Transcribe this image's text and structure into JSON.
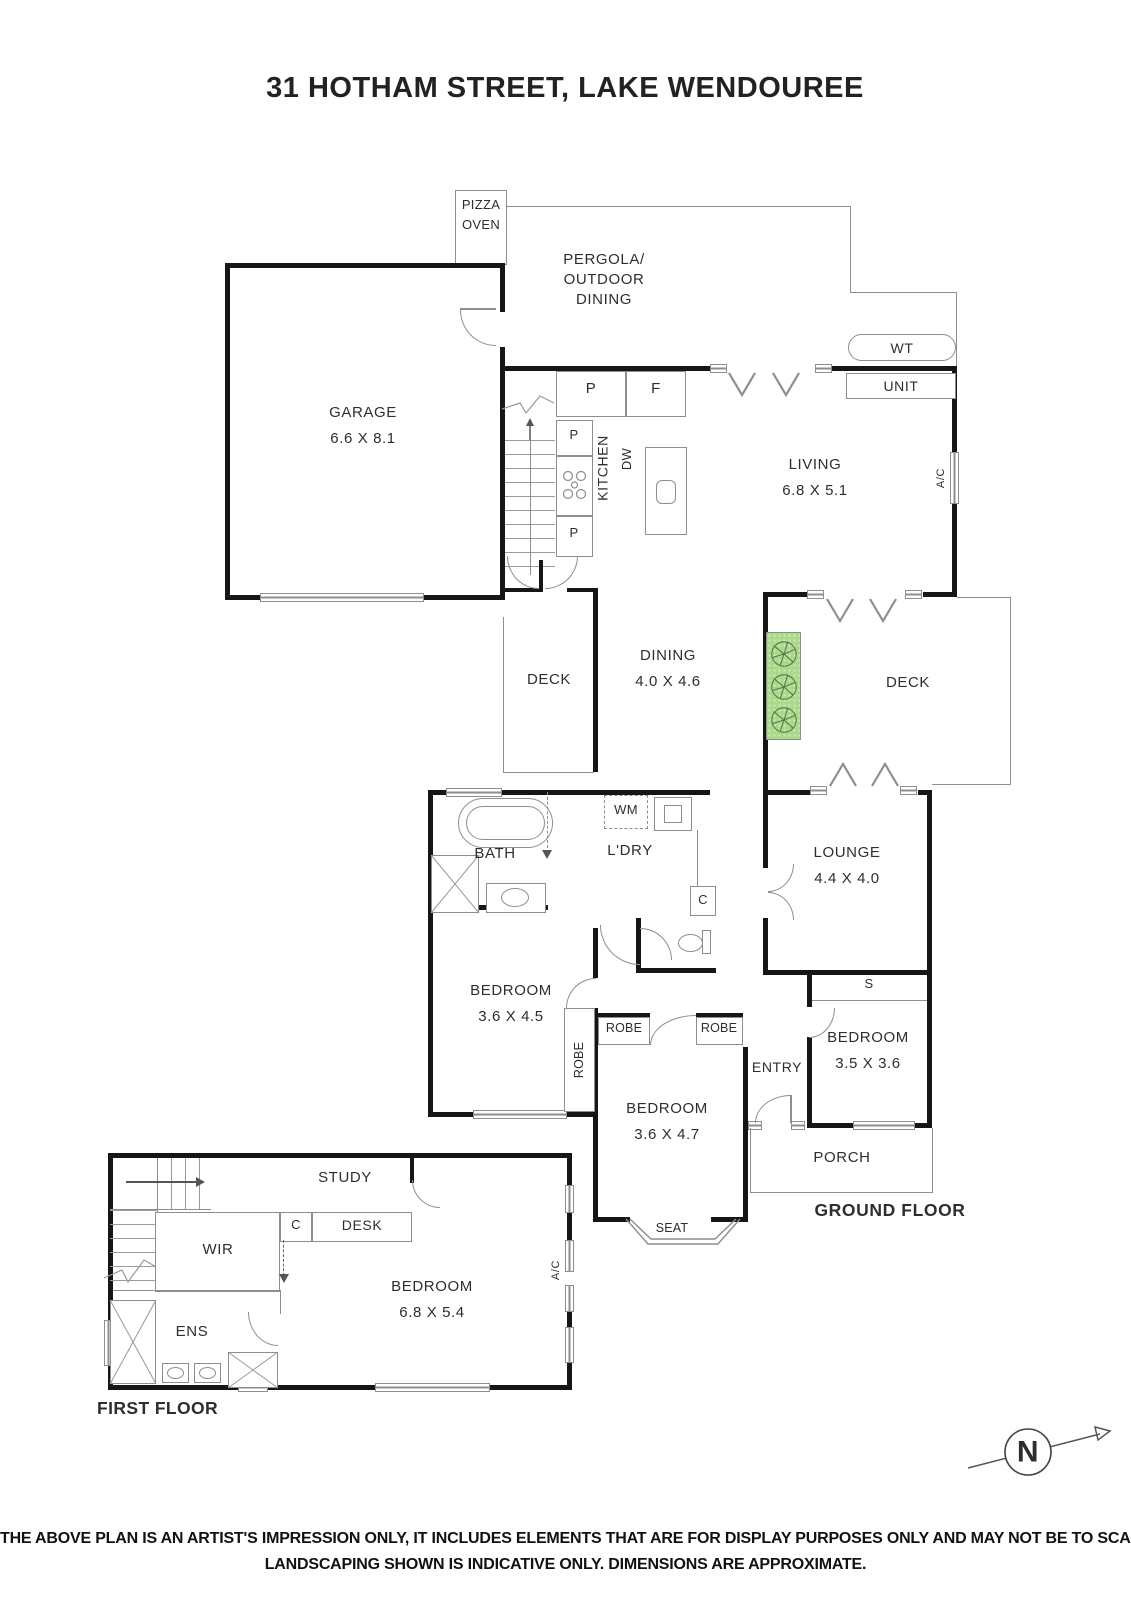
{
  "title": "31 HOTHAM STREET, LAKE WENDOUREE",
  "ground_floor": {
    "label": "GROUND FLOOR",
    "pizza_oven": {
      "line1": "PIZZA",
      "line2": "OVEN"
    },
    "pergola": {
      "line1": "PERGOLA/",
      "line2": "OUTDOOR",
      "line3": "DINING"
    },
    "garage": {
      "name": "GARAGE",
      "dims": "6.6 X 8.1"
    },
    "kitchen": {
      "name": "KITCHEN"
    },
    "living": {
      "name": "LIVING",
      "dims": "6.8 X 5.1"
    },
    "dining": {
      "name": "DINING",
      "dims": "4.0 X 4.6"
    },
    "deck": "DECK",
    "lounge": {
      "name": "LOUNGE",
      "dims": "4.4 X 4.0"
    },
    "bath": {
      "name": "BATH"
    },
    "laundry": {
      "name": "L'DRY"
    },
    "bedroom_rear": {
      "name": "BEDROOM",
      "dims": "3.6 X 4.5"
    },
    "bedroom_middle": {
      "name": "BEDROOM",
      "dims": "3.6 X 4.7"
    },
    "bedroom_front": {
      "name": "BEDROOM",
      "dims": "3.5 X 3.6"
    },
    "entry": "ENTRY",
    "porch": "PORCH",
    "seat": "SEAT",
    "fixtures": {
      "pantry": "P",
      "fridge": "F",
      "dishwasher": "DW",
      "washing_machine": "WM",
      "cupboard": "C",
      "storage": "S",
      "water_tank": "WT",
      "unit": "UNIT",
      "air_conditioner": "A/C",
      "robe": "ROBE"
    }
  },
  "first_floor": {
    "label": "FIRST FLOOR",
    "study": {
      "name": "STUDY"
    },
    "wir": {
      "name": "WIR"
    },
    "ens": {
      "name": "ENS"
    },
    "desk": "DESK",
    "cupboard": "C",
    "bedroom": {
      "name": "BEDROOM",
      "dims": "6.8 X 5.4"
    },
    "air_conditioner": "A/C"
  },
  "compass": {
    "north": "N"
  },
  "disclaimer": {
    "line1": "THE ABOVE PLAN IS AN ARTIST'S IMPRESSION ONLY, IT INCLUDES ELEMENTS THAT ARE FOR DISPLAY PURPOSES ONLY AND MAY NOT BE TO SCALE.",
    "line2": "LANDSCAPING SHOWN IS INDICATIVE ONLY. DIMENSIONS ARE APPROXIMATE."
  },
  "colors": {
    "wall": "#161616",
    "line": "#8e8e8e",
    "garden_fill": "#abd98b",
    "garden_dot": "#cdeab3",
    "tree_stroke": "#55744e"
  }
}
